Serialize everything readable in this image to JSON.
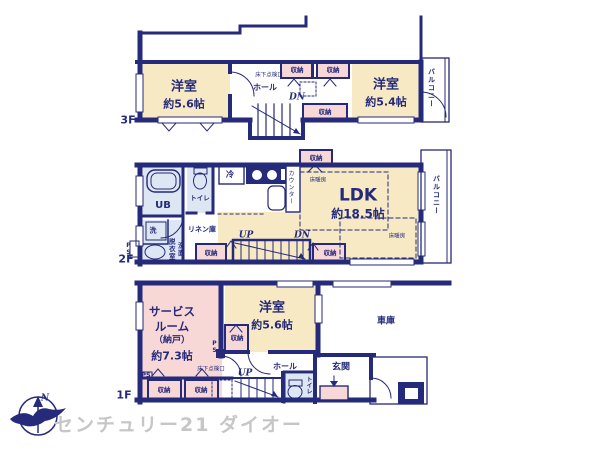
{
  "f3": {
    "floor": "3F",
    "room_left_name": "洋室",
    "room_left_size": "約5.6帖",
    "room_right_name": "洋室",
    "room_right_size": "約5.4帖",
    "hall": "ホール",
    "dn": "DN",
    "closet_a": "収納",
    "closet_b": "収納",
    "closet_c": "収納",
    "hatch": "床下点検口",
    "balcony": "バルコニー"
  },
  "f2": {
    "floor": "2F",
    "ldk_name": "LDK",
    "ldk_size": "約18.5帖",
    "ub": "UB",
    "toilet": "トイレ",
    "fridge": "冷",
    "counter": "カウンター",
    "heating_a": "床暖房",
    "heating_b": "床暖房",
    "closet_top": "収納",
    "closet_left": "収納",
    "closet_right": "収納",
    "washer": "洗",
    "dressing_room": "脱衣室",
    "washbasin": "洗面",
    "linen": "リネン庫",
    "up": "UP",
    "dn": "DN",
    "ps": "PS",
    "balcony": "バルコニー"
  },
  "f1": {
    "floor": "1F",
    "service_line1": "サービス",
    "service_line2": "ルーム",
    "service_line3": "（納戸）",
    "service_line4": "約7.3帖",
    "room_name": "洋室",
    "room_size": "約5.6帖",
    "garage": "車庫",
    "entrance": "玄関",
    "hall": "ホール",
    "toilet": "トイレ",
    "up": "UP",
    "hatch": "床下点検口",
    "closet_a": "収納",
    "closet_b": "収納",
    "closet_mid": "収納",
    "ps_a": "PS",
    "ps_b": "PS"
  },
  "compass": {
    "north": "N"
  },
  "footer": {
    "brand": "センチュリー21 ダイオー"
  },
  "colors": {
    "wall_navy": "#252a7a",
    "room_cream": "#f6e9c4",
    "closet_pink": "#f8d8d6",
    "wet_blue": "#dde7f4",
    "brand_gray": "#c6c6c6"
  }
}
